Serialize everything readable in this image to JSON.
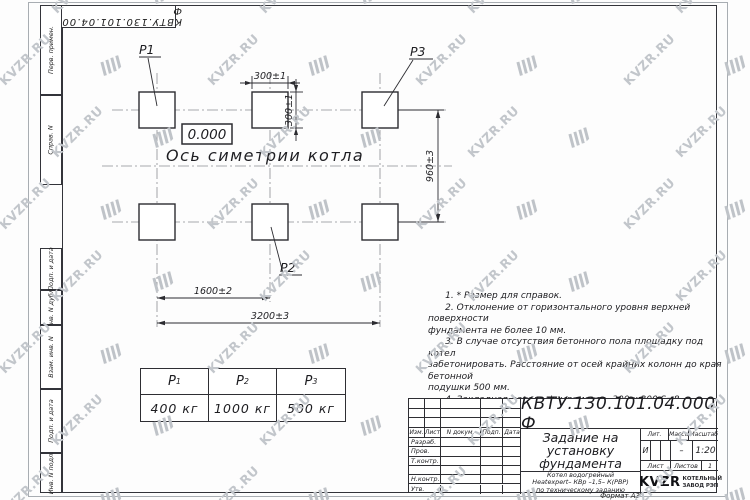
{
  "watermark": {
    "text": "KVZR.RU"
  },
  "page": {
    "format_label": "Формат А3"
  },
  "margin_stamps": [
    "Перв. примен.",
    "Справ. N",
    "Подп. и дата",
    "Инв. N дубл.",
    "Взам. инв. N",
    "Подп. и дата",
    "Инв. N подл."
  ],
  "drawing": {
    "elevation": "0.000",
    "axis_label": "Ось симетрии котла",
    "points": {
      "p1": "Р1",
      "p2": "Р2",
      "p3": "Р3"
    },
    "dims": {
      "d300h": "300±1",
      "d300v": "300±1",
      "d960": "960±3",
      "d1600": "1600±2",
      "d3200": "3200±3"
    }
  },
  "loads_table": {
    "headers": [
      {
        "b": "Р",
        "s": "1"
      },
      {
        "b": "Р",
        "s": "2"
      },
      {
        "b": "Р",
        "s": "3"
      }
    ],
    "values": [
      "400 кг",
      "1000 кг",
      "500 кг"
    ]
  },
  "notes": {
    "text": "      1. * Размер для справок.\n      2. Отклонение от горизонтального уровня верхней поверхности\nфундамента не более 10 мм.\n      3. В случае отсутствия бетонного пола площадку под котел\nзабетонировать. Расстояние от осей крайних колонн до края бетонной\nподушки 500 мм.\n      4. Закладная деталь фундамента  300 х 300 S=8.\n      5. Фундамент под котел разрабатывает проектная организация\nпо нагрузкам на фундамент."
  },
  "title_block": {
    "doc_number": "КВТУ.130.101.04.000  Ф",
    "doc_title": "Задание на\nустановку\nфундамента",
    "subject": "Котел водогрейный\nHeatexpert– КВр –1,5– К(РВР)\nпо техническому заданию",
    "rev_headers": [
      "Изм.",
      "Лист",
      "N докум.",
      "Подп.",
      "Дата"
    ],
    "sig_rows": [
      "Разраб.",
      "Пров.",
      "Т.контр.",
      "",
      "Н.контр.",
      "Утв."
    ],
    "lit_label": "Лит.",
    "lit_value": "И",
    "mass_label": "Масса",
    "mass_value": "–",
    "scale_label": "Масштаб",
    "scale_value": "1:20",
    "sheet_label": "Лист",
    "sheets_label": "Листов",
    "sheets_value": "1",
    "logo_text": "KVZR",
    "logo_caption": "КОТЕЛЬНЫЙ\nЗАВОД РЭП"
  }
}
